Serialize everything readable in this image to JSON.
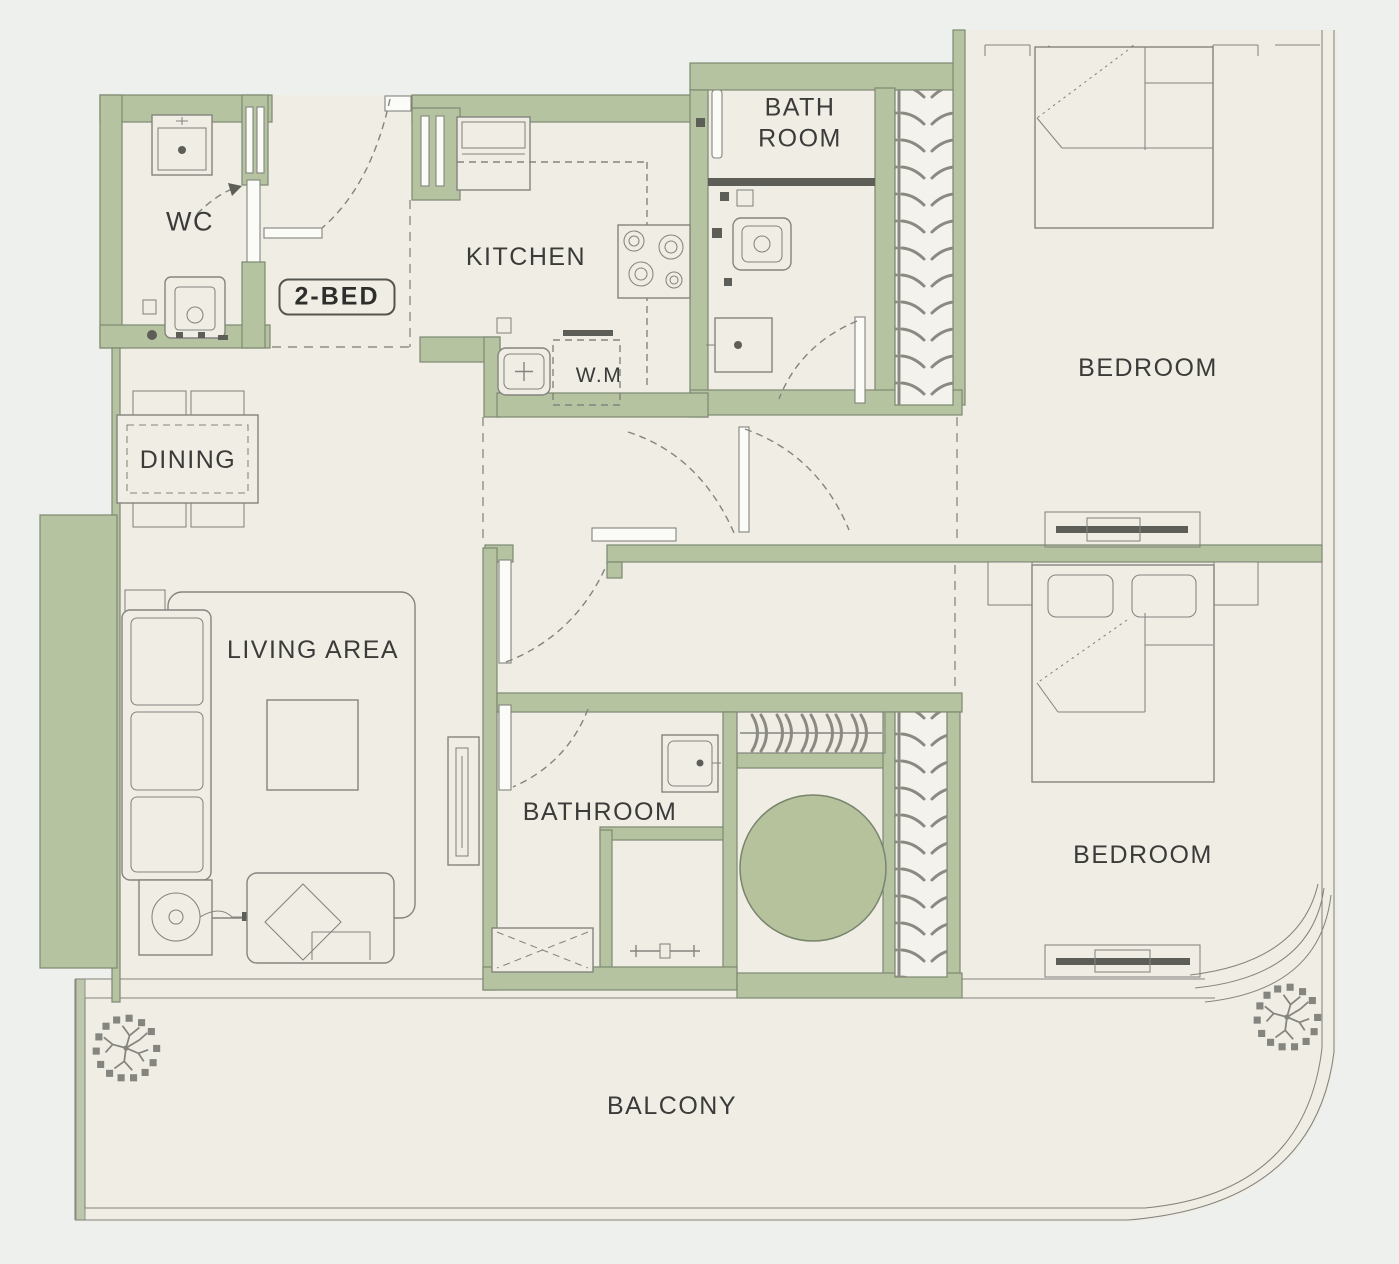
{
  "plan": {
    "unit_badge": "2-BED",
    "labels": {
      "wc": "WC",
      "kitchen": "KITCHEN",
      "wm": "W.M",
      "bath_top_line1": "BATH",
      "bath_top_line2": "ROOM",
      "bedroom_top": "BEDROOM",
      "bedroom_bottom": "BEDROOM",
      "dining": "DINING",
      "living": "LIVING AREA",
      "bathroom": "BATHROOM",
      "balcony": "BALCONY"
    },
    "colors": {
      "wall": "#b6c3a0",
      "wall_outline": "#7d8872",
      "floor": "#f0ede5",
      "background": "#eef0ed",
      "line": "#84847e",
      "dark": "#5e5e58",
      "accent_circle": "#b5c29c",
      "text": "#3b3b39"
    }
  }
}
